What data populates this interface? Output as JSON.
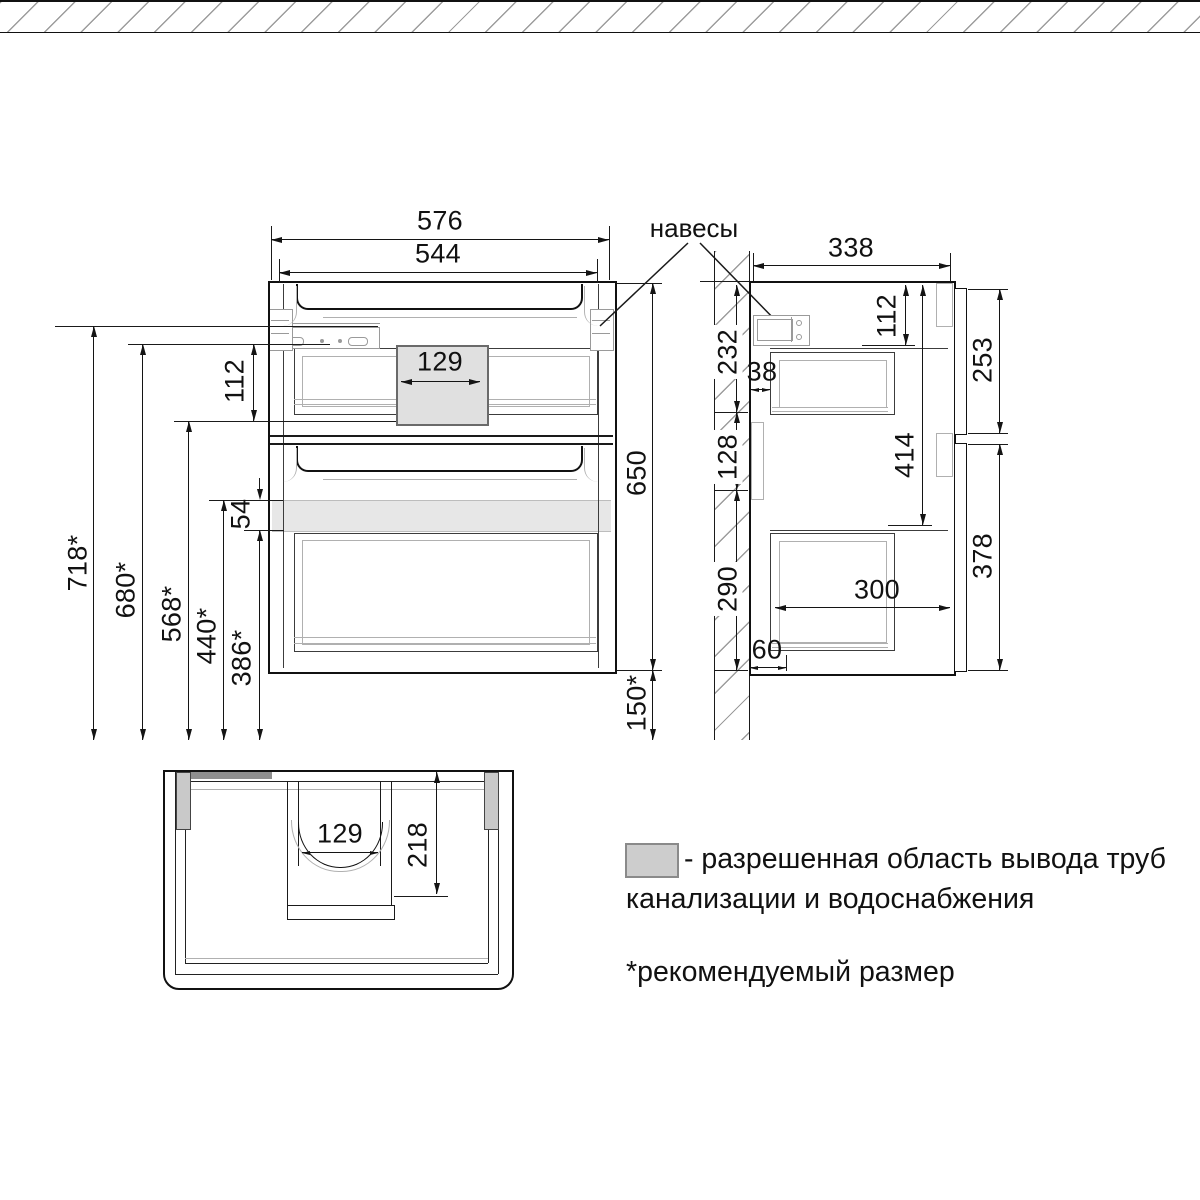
{
  "labels": {
    "hangers": "навесы"
  },
  "front_view": {
    "width_outer": "576",
    "width_inner": "544",
    "pipe_gap_width": "129",
    "height": "650",
    "floor_gap": "150*",
    "h_total": "718*",
    "h_top": "680*",
    "h_pipe_bottom": "568*",
    "h_band_top": "440*",
    "h_band_bottom": "386*",
    "top_inset": "112",
    "band_height": "54"
  },
  "side_view": {
    "depth": "338",
    "top_inset": "112",
    "wall_seg_top": "232",
    "back_gap": "38",
    "wall_seg_mid": "128",
    "wall_seg_bottom": "290",
    "inner_height": "414",
    "front_top_h": "253",
    "front_bottom_h": "378",
    "drawer_depth": "300",
    "bottom_back_gap": "60"
  },
  "bottom_view": {
    "pipe_gap_width": "129",
    "pipe_gap_depth": "218"
  },
  "legend": {
    "swatch_color": "#cdcdcd",
    "swatch_border": "#8a8a8a",
    "line1": "- разрешенная область вывода труб",
    "line2": "канализации и водоснабжения",
    "note": "*рекомендуемый размер"
  },
  "colors": {
    "line": "#1a1a1a",
    "hatch": "#9c9c9c",
    "hardware": "#9a9a9a",
    "pipe_zone_fill": "#e0e0e0",
    "pipe_zone_border": "#6a6a6a",
    "band_fill": "#e7e7e7",
    "mount_strip": "#8f8f8f"
  }
}
